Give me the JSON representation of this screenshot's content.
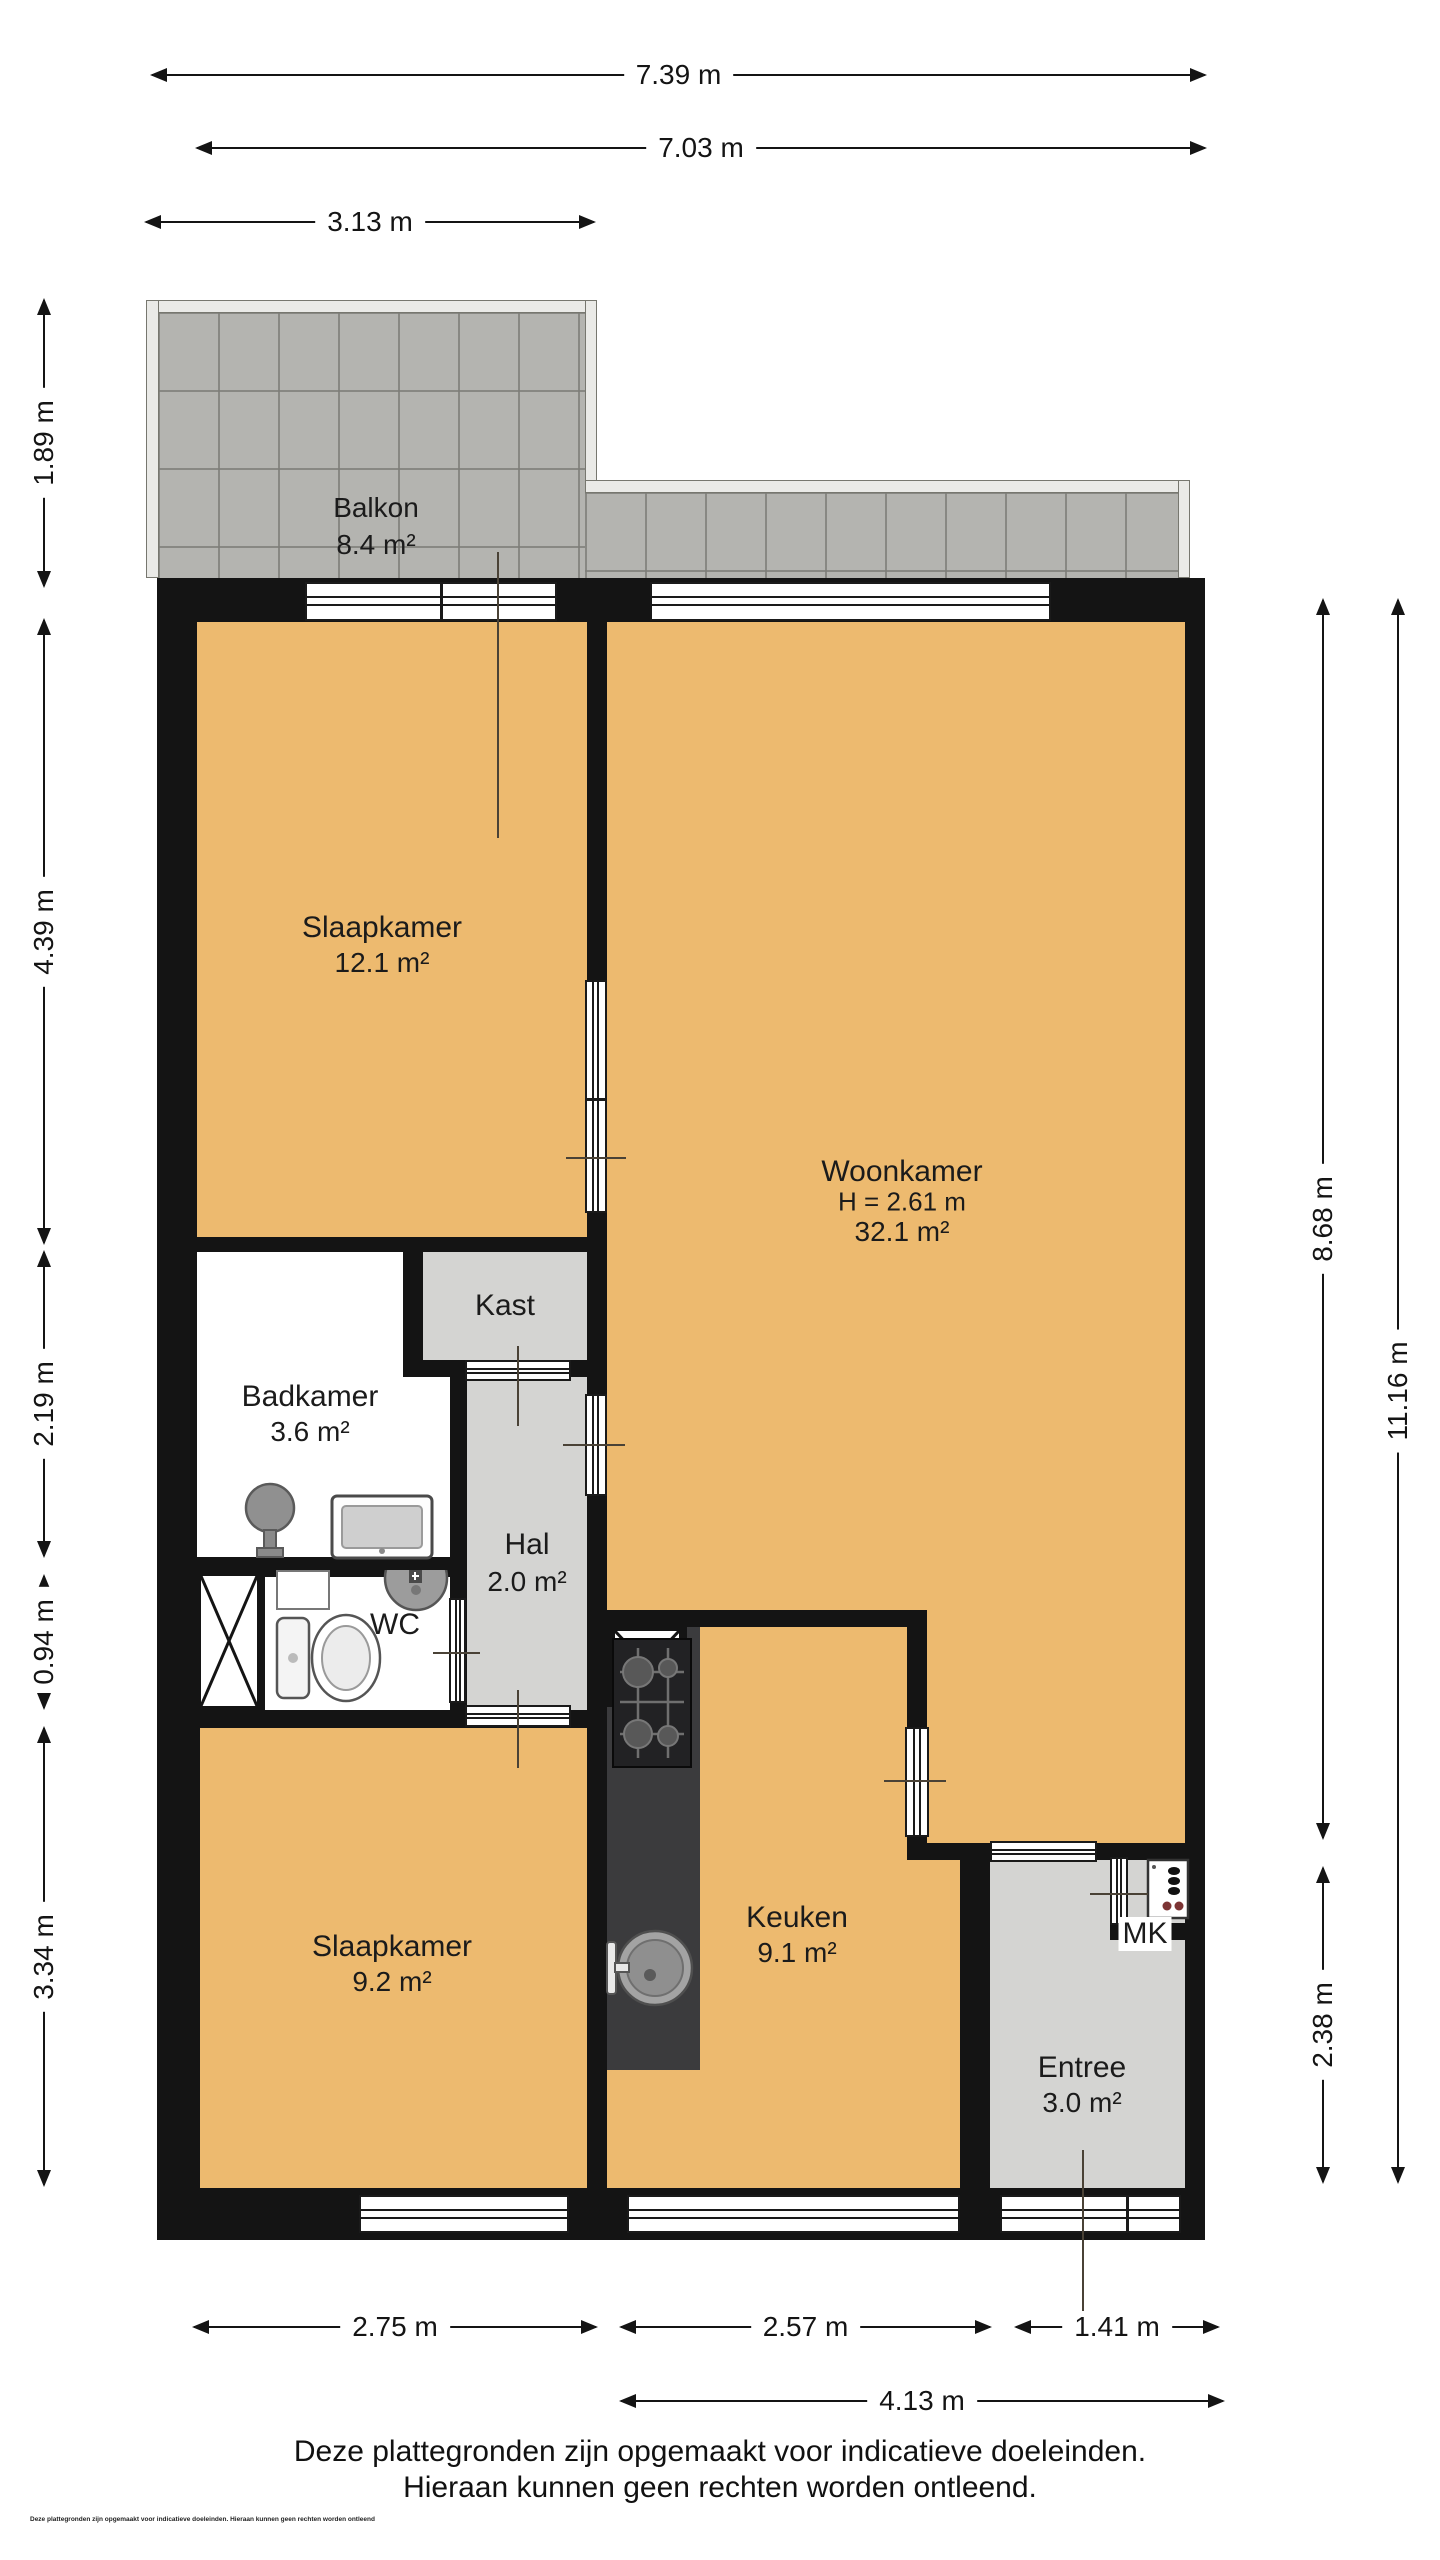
{
  "meta": {
    "title": "Floor plan (plattegrond)",
    "colors": {
      "wall": "#141414",
      "floor_orange": "#EDBA6F",
      "floor_gray": "#D4D4D2",
      "floor_white": "#FFFFFF",
      "balcony_tile": "#B4B4B0",
      "balcony_rail": "#EAEAE7",
      "counter_dark": "#3B3B3D",
      "background": "#FFFFFF",
      "text": "#1B1B1B"
    }
  },
  "rooms": {
    "balkon": {
      "name": "Balkon",
      "area": "8.4 m²"
    },
    "slaapkamer_1": {
      "name": "Slaapkamer",
      "area": "12.1 m²"
    },
    "woonkamer": {
      "name": "Woonkamer",
      "height": "H = 2.61 m",
      "area": "32.1 m²"
    },
    "kast": {
      "name": "Kast"
    },
    "badkamer": {
      "name": "Badkamer",
      "area": "3.6 m²"
    },
    "hal": {
      "name": "Hal",
      "area": "2.0 m²"
    },
    "wc": {
      "name": "WC"
    },
    "keuken": {
      "name": "Keuken",
      "area": "9.1 m²"
    },
    "slaapkamer_2": {
      "name": "Slaapkamer",
      "area": "9.2 m²"
    },
    "entree": {
      "name": "Entree",
      "area": "3.0 m²"
    },
    "mk": {
      "name": "MK"
    }
  },
  "dimensions": {
    "top": {
      "d739": "7.39 m",
      "d703": "7.03 m",
      "d313": "3.13 m"
    },
    "left": {
      "d189": "1.89 m",
      "d439": "4.39 m",
      "d219": "2.19 m",
      "d094": "0.94 m",
      "d334": "3.34 m"
    },
    "right": {
      "d868": "8.68 m",
      "d238": "2.38 m",
      "d1116": "11.16 m"
    },
    "bottom": {
      "d275": "2.75 m",
      "d257": "2.57 m",
      "d141": "1.41 m",
      "d413": "4.13 m"
    }
  },
  "footer": {
    "line1": "Deze plattegronden zijn opgemaakt voor indicatieve doeleinden.",
    "line2": "Hieraan kunnen geen rechten worden ontleend.",
    "fineprint": "Deze plattegronden zijn opgemaakt voor indicatieve doeleinden. Hieraan kunnen geen rechten worden ontleend"
  }
}
